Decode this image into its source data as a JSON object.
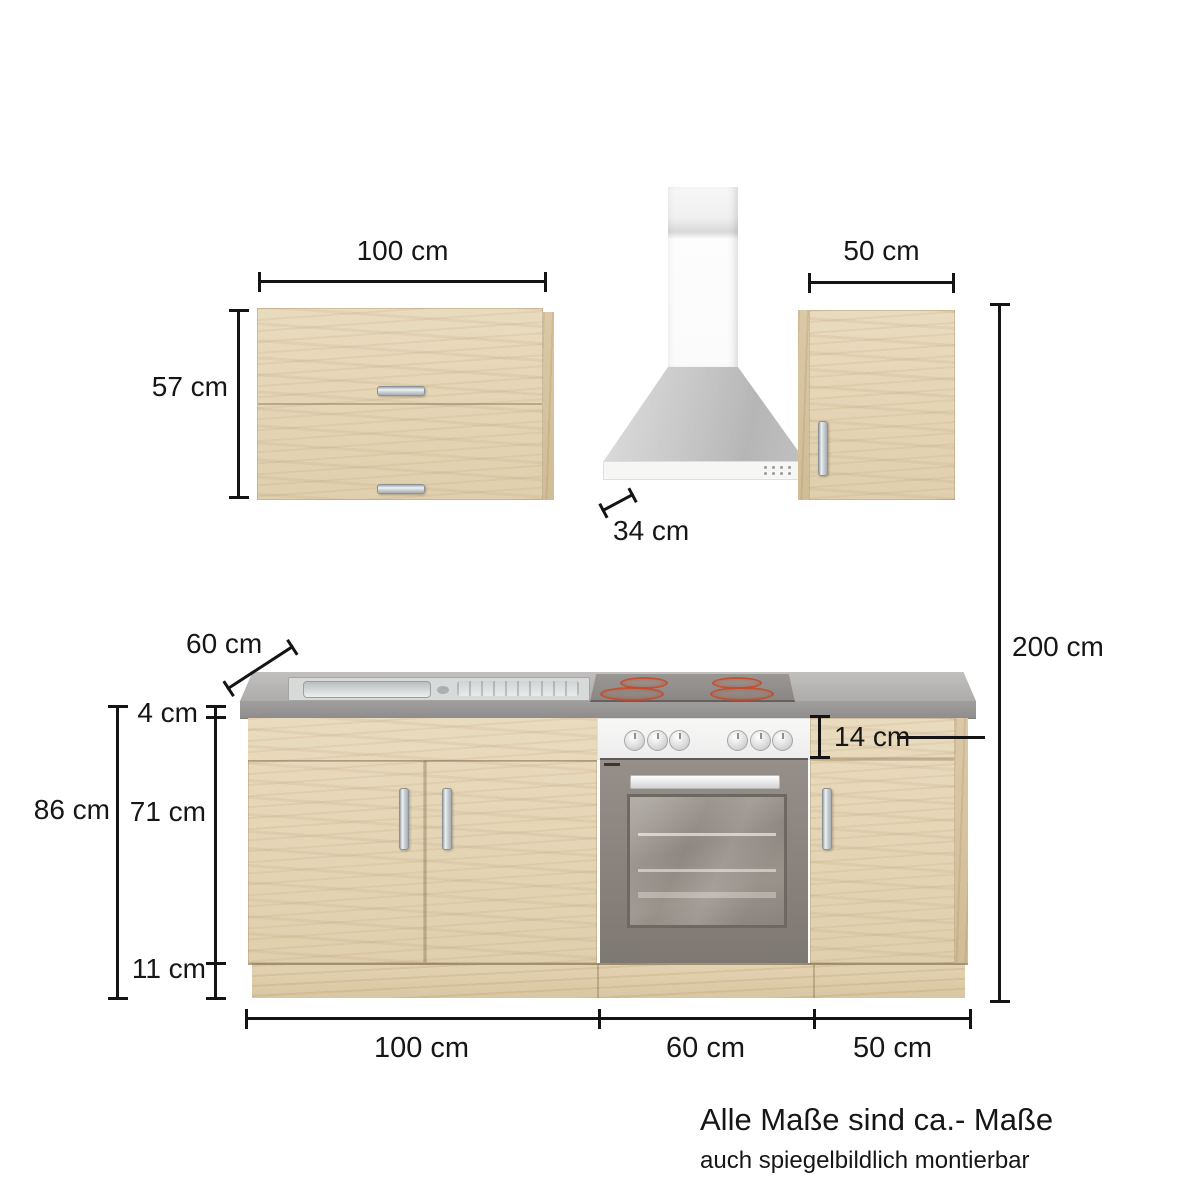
{
  "dimensions": {
    "wall_cabinet_left_width": "100 cm",
    "wall_cabinet_left_height": "57 cm",
    "wall_cabinet_depth": "34 cm",
    "wall_cabinet_right_width": "50 cm",
    "total_height": "200 cm",
    "worktop_depth": "60 cm",
    "worktop_thickness": "4 cm",
    "base_total_height": "86 cm",
    "base_front_height": "71 cm",
    "plinth_height": "11 cm",
    "oven_panel_height": "14 cm",
    "base_sink_section_width": "100 cm",
    "base_oven_section_width": "60 cm",
    "base_right_section_width": "50 cm"
  },
  "notes": {
    "line1": "Alle Maße sind ca.- Maße",
    "line2": "auch spiegelbildlich montierbar"
  },
  "colors": {
    "wood": "#e4d5b6",
    "wood_side": "#d5c29e",
    "worktop_gray": "#a7a6a4",
    "hood_steel": "#c4c4c4",
    "oven_body": "#8b847e",
    "burner_red": "#c44b28",
    "dimension_line": "#141414",
    "background": "#ffffff"
  }
}
